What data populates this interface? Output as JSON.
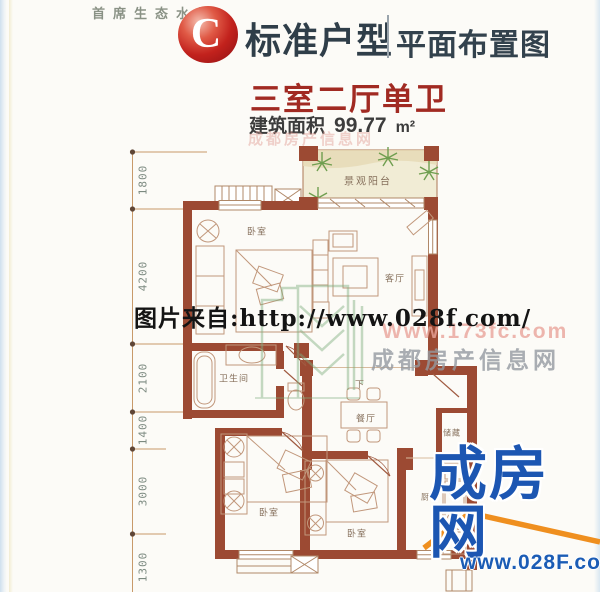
{
  "header": {
    "tagline": "首席生态水景",
    "badge_letter": "C",
    "title": "标准户型",
    "subtitle": "平面布置图"
  },
  "unit": {
    "title": "三室二厅单卫",
    "area_label": "建筑面积",
    "area_value": "99.77",
    "area_unit": "m²"
  },
  "dimensions": [
    "1800",
    "4200",
    "2100",
    "1400",
    "3000",
    "1300"
  ],
  "rooms": {
    "balcony": "景观阳台",
    "bedroom_top": "卧室",
    "living": "客厅",
    "bathroom": "卫生间",
    "dining": "餐厅",
    "stairs_down": "下",
    "storage": "储藏",
    "bedroom_left": "卧室",
    "bedroom_mid": "卧室",
    "kitchen": "厨房"
  },
  "watermarks": {
    "credit": "图片来自:http://www.028f.com/",
    "site_url": "Www.173fc.com",
    "site_name": "成都房产信息网"
  },
  "logo": {
    "name": "成房网",
    "url": "www.028F.com"
  },
  "colors": {
    "wall": "#9c4a33",
    "furniture_line": "#c1977b",
    "dimension_line": "#c89a6a",
    "accent_red": "#a12a22",
    "title_dark": "#2f3e49",
    "logo_blue": "#1c56b2",
    "logo_orange": "#ef8f1f",
    "balcony_fill": "#f1ecd5",
    "plant_green": "#6f9e4f"
  }
}
